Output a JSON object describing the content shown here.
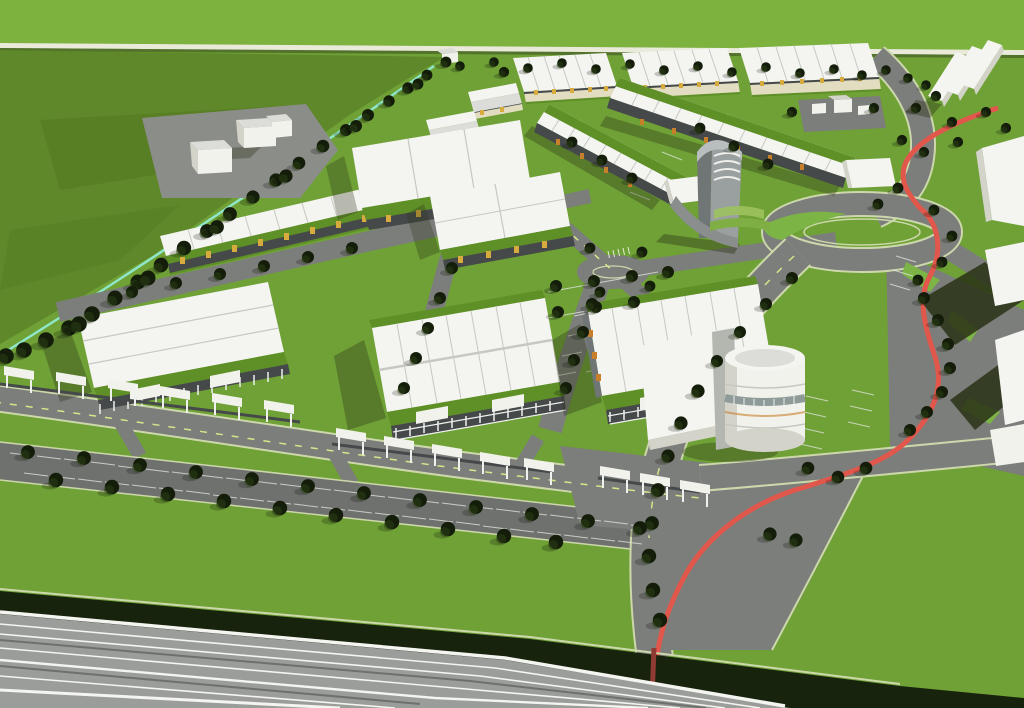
{
  "scene": {
    "description": "Aerial 3D architectural rendering of a business-park master plan: rows of white-roofed warehouse buildings with green roof aprons and yellow unit accents, tree-lined internal streets, a red cycle path winding from the top right to the bottom, a roundabout with a green island, a cylindrical corner building, a grey landmark tower, white canopy fences, large parking lots, open green fields with a diagonal tree line, and a multi-lane motorway crossing the bottom left corner."
  },
  "colors": {
    "grass_bright": "#7db23f",
    "grass_field": "#5e8829",
    "grass_lawn": "#6fa136",
    "grass_lawn2": "#7cb445",
    "grass_roof": "#5f9027",
    "hedge": "#17230c",
    "tree_dark": "#131d0a",
    "tree_olive": "#2c4214",
    "path_pale": "#eaeadb",
    "cyan_edge": "#8fe6c8",
    "asphalt": "#7c7e7b",
    "asphalt_dark": "#6f716f",
    "highway_gray": "#9b9d9a",
    "white_line": "#f4f4f0",
    "edge_line": "#ccd8ab",
    "lane_dash": "#d8e48a",
    "roof_white": "#f4f4f1",
    "roof_shade": "#dcddd8",
    "roof_rib": "#c6c8c2",
    "facade_dark": "#45494a",
    "facade_cream": "#e2dcc0",
    "post_white": "#eff1ee",
    "accent_yellow": "#d8ab3f",
    "accent_orange": "#c77f2b",
    "cycle_red": "#e2574c",
    "cycle_red_dark": "#8f3a33",
    "tower_gray": "#9aa0a0",
    "tower_dark": "#707576",
    "box_white": "#f2f2ec",
    "box_side": "#d3d3ca",
    "shadow_dark": "#2a3116",
    "glass_band": "#8e9b98"
  }
}
